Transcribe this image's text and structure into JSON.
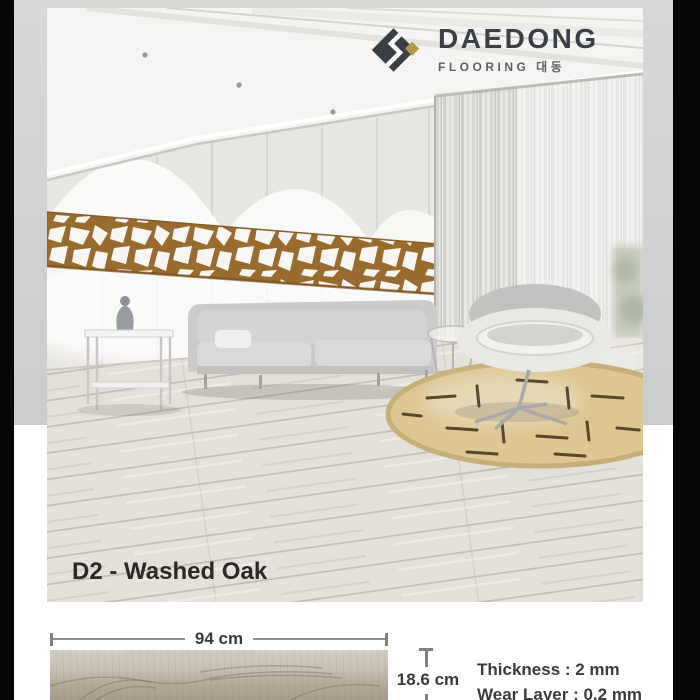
{
  "brand": {
    "name": "DAEDONG",
    "subtitle": "FLOORING 대동",
    "logo_icon": "daedong-diamond-logo"
  },
  "product": {
    "label": "D2 - Washed Oak"
  },
  "dimensions": {
    "width": "94 cm",
    "height": "18.6 cm"
  },
  "specs": [
    {
      "label": "Thickness : 2 mm"
    },
    {
      "label": "Wear Layer : 0.2 mm"
    }
  ],
  "colors": {
    "brand_dark": "#3a3e45",
    "brand_gold": "#b5974a",
    "lattice_bronze": "#9a6b2e",
    "rug_beige": "#dcc694",
    "floor_oak": "#e2dfd8",
    "sample_oak": "#b9ae9c",
    "background_gray": "#d3d4d6",
    "frame_black": "#000000"
  }
}
